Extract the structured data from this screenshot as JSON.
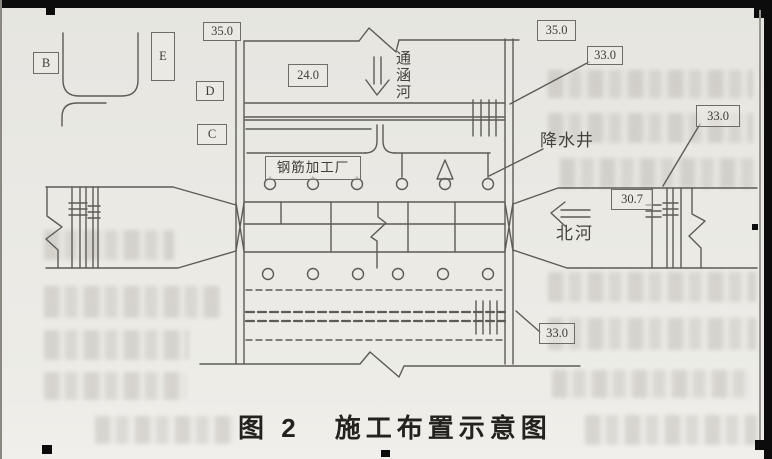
{
  "figure": {
    "caption_prefix": "图 2",
    "caption_title": "施工布置示意图"
  },
  "map_labels": {
    "building_b": "B",
    "building_e": "E",
    "building_d": "D",
    "building_c": "C",
    "rebar_yard": "钢筋加工厂",
    "dewatering_wells": "降水井",
    "tonghan_river": "通涵河",
    "bei_river": "北河"
  },
  "elevations": {
    "left_road_top": "35.0",
    "right_road_top": "35.0",
    "canal_crossing": "33.0",
    "right_bank": "33.0",
    "south_road": "33.0",
    "yard": "24.0",
    "river_level": "30.7"
  },
  "colors": {
    "paper": "#eae9e4",
    "line": "#5d5b55",
    "ink": "#3f3d38",
    "caption": "#24221e",
    "boxborder": "#6e6c65"
  }
}
